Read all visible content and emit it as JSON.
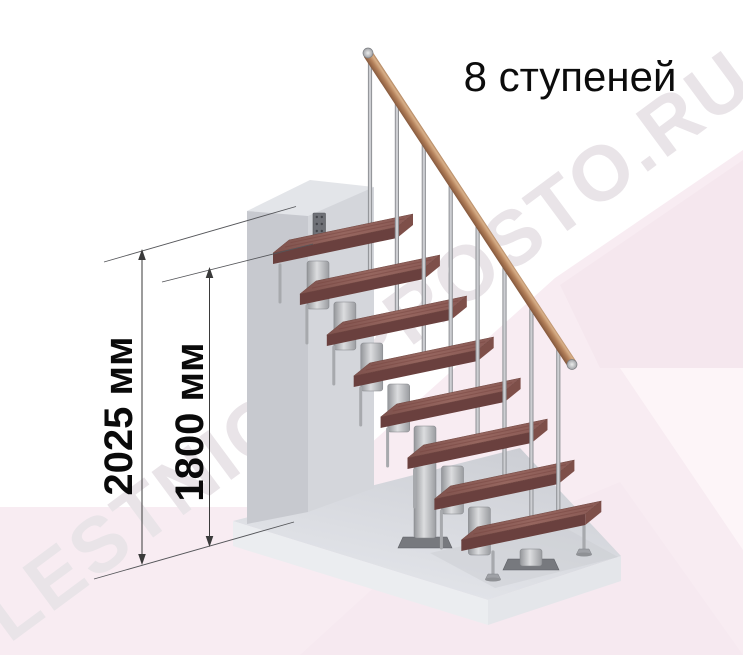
{
  "title": {
    "text": "8 ступеней"
  },
  "dimensions": {
    "total_height": {
      "label": "2025 мм",
      "value": 2025,
      "unit": "мм"
    },
    "step_level_height": {
      "label": "1800 мм",
      "value": 1800,
      "unit": "мм"
    }
  },
  "watermark": {
    "text": "LESTNICA-PROSTO.RU"
  },
  "staircase": {
    "steps_count": 8,
    "type": "modular-monostringer",
    "parts": [
      "treads",
      "handrail",
      "balusters",
      "stringer-modules",
      "support-columns",
      "wall-mount-plate",
      "base-platform",
      "wall-column"
    ]
  },
  "colors": {
    "background": "#ffffff",
    "background_pink": "#f8ecf2",
    "background_pink_deep": "#f5e7ee",
    "background_pink_light": "#fdf5f8",
    "tread_top": "#8f605b",
    "tread_front": "#6a403e",
    "tread_side": "#7e4f49",
    "handrail_wood": "#b4815b",
    "metal": "#c3c4c8",
    "metal_dark": "#8f9195",
    "metal_light": "#cdced2",
    "leg_metal": "#a7a9ad",
    "wall_front": "#d4d6db",
    "wall_left": "#c7c9cf",
    "wall_top": "#e3e5e9",
    "platform_top": "#d6d8dd",
    "platform_front": "#ebedf0",
    "plate_metal": "#77797e",
    "dimension_line": "#3a3a3a",
    "text": "#0c0c0c",
    "watermark": "#e9e4e8"
  }
}
